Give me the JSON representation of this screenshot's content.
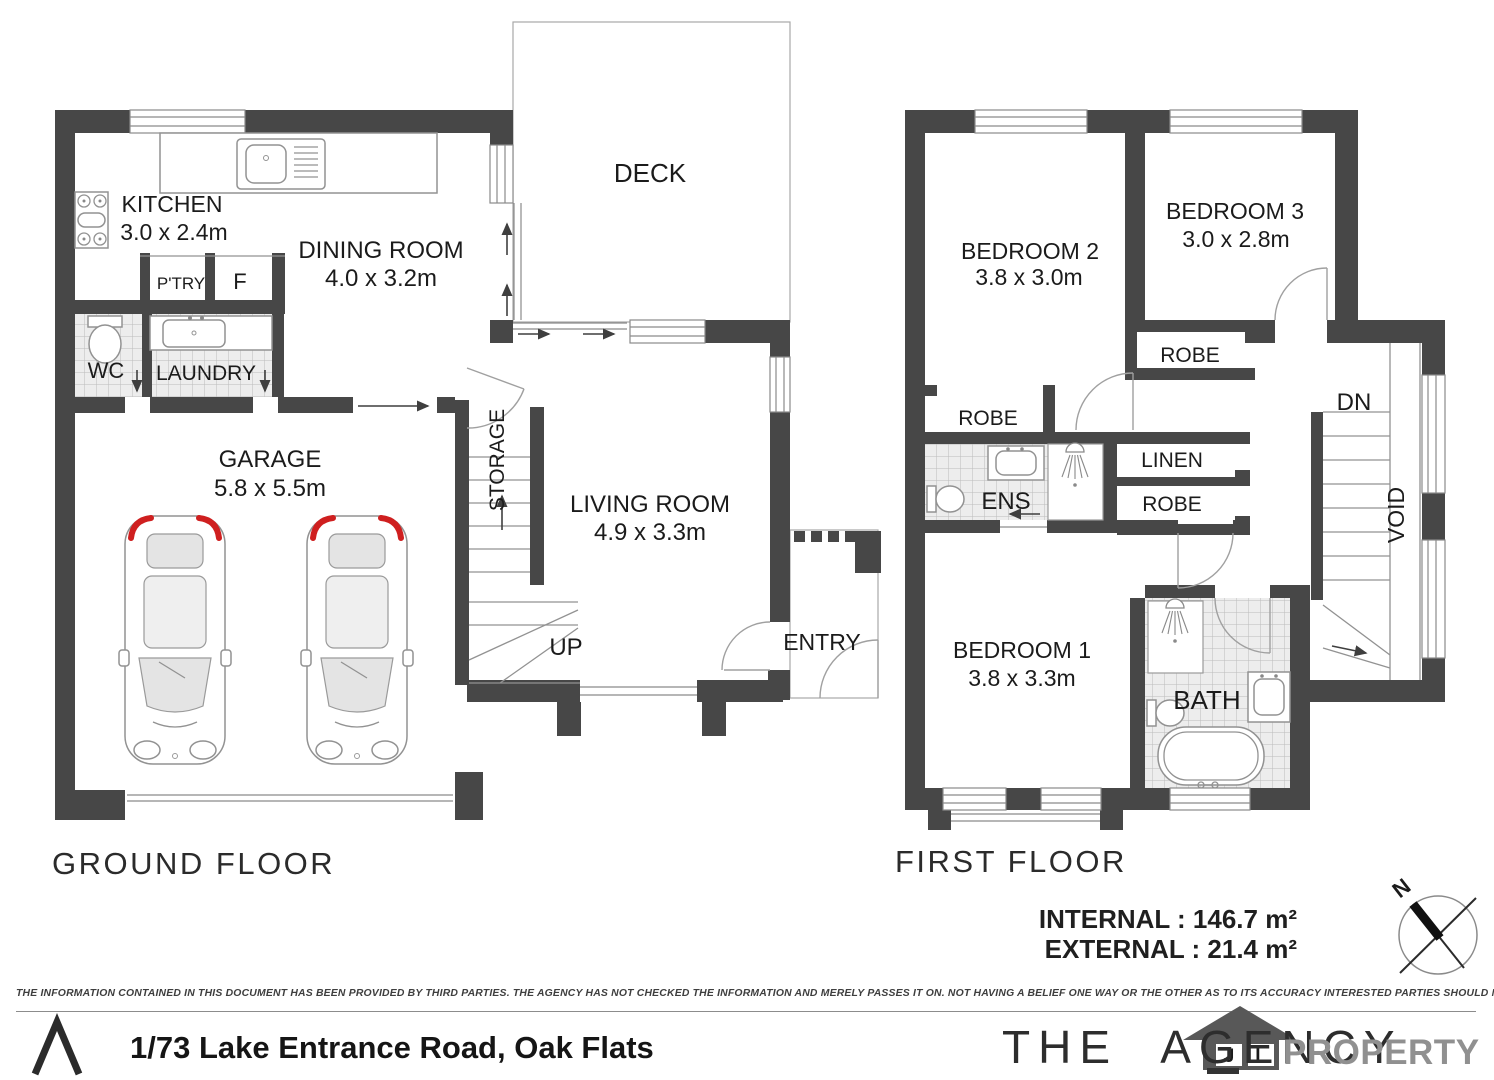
{
  "meta": {
    "wall_color": "#474747",
    "tile_color": "#ececec",
    "car_accent_red": "#cf1f1f",
    "brand_gray": "#909090"
  },
  "gf": {
    "title": "GROUND FLOOR",
    "kitchen": "KITCHEN",
    "kitchen_dims": "3.0 x 2.4m",
    "dining": "DINING ROOM",
    "dining_dims": "4.0 x 3.2m",
    "deck": "DECK",
    "pantry": "P'TRY",
    "fridge": "F",
    "wc": "WC",
    "laundry": "LAUNDRY",
    "garage": "GARAGE",
    "garage_dims": "5.8 x 5.5m",
    "storage": "STORAGE",
    "living": "LIVING ROOM",
    "living_dims": "4.9 x 3.3m",
    "up": "UP",
    "entry": "ENTRY"
  },
  "ff": {
    "title": "FIRST FLOOR",
    "bed2": "BEDROOM 2",
    "bed2_dims": "3.8 x 3.0m",
    "bed3": "BEDROOM 3",
    "bed3_dims": "3.0 x 2.8m",
    "robe_bed3": "ROBE",
    "robe_bed2": "ROBE",
    "robe_hall": "ROBE",
    "linen": "LINEN",
    "ens": "ENS",
    "dn": "DN",
    "void": "VOID",
    "bed1": "BEDROOM 1",
    "bed1_dims": "3.8 x 3.3m",
    "bath": "BATH",
    "internal_area": "INTERNAL : 146.7 m²",
    "external_area": "EXTERNAL : 21.4 m²",
    "compass_n": "N"
  },
  "footer": {
    "disclaimer": "THE INFORMATION CONTAINED IN THIS DOCUMENT HAS BEEN PROVIDED BY THIRD PARTIES. THE AGENCY HAS NOT CHECKED THE INFORMATION AND MERELY PASSES IT ON. NOT HAVING A BELIEF ONE WAY OR  THE OTHER AS TO ITS ACCURACY   INTERESTED PARTIES SHOULD MAKE AND RELY UPON THEIR OWN ENQUIRIES.",
    "address": "1/73 Lake Entrance Road, Oak Flats",
    "brand_main": "THE AGENCY",
    "brand_sub": "PROPERTY",
    "house_letter_1": "J",
    "house_letter_2": "L"
  }
}
